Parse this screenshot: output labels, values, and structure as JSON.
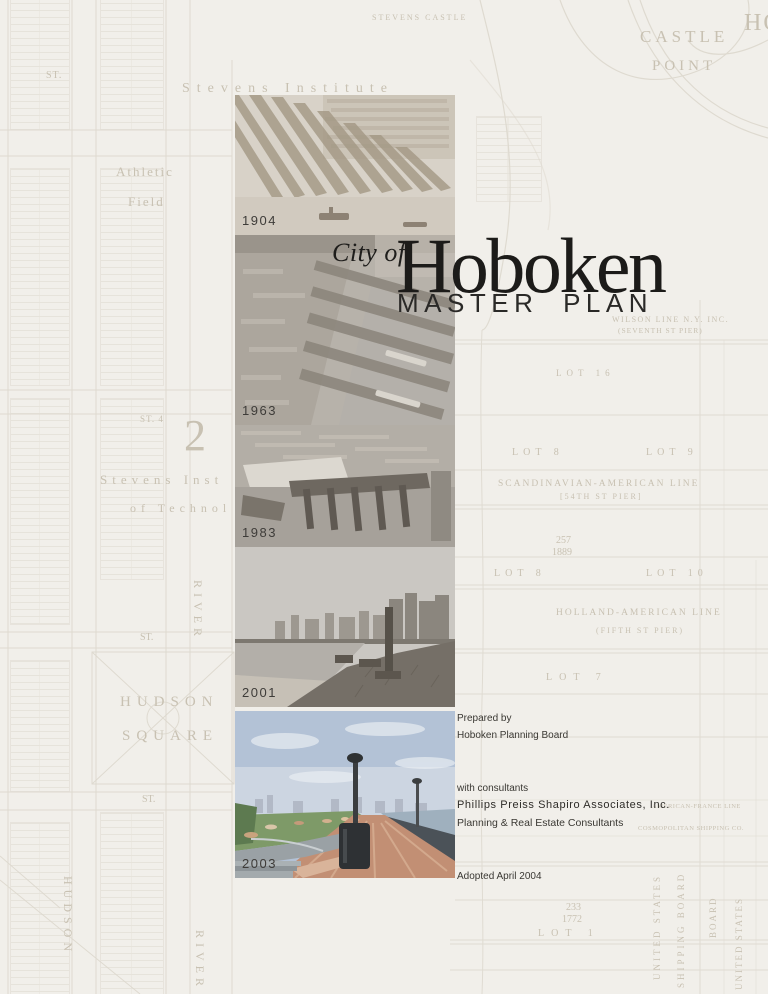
{
  "title": {
    "prefix": "City of",
    "name": "Hoboken",
    "subtitle": "MASTER PLAN"
  },
  "photos": [
    {
      "year": "1904",
      "description": "sepia aerial view of Hoboken piers"
    },
    {
      "year": "1963",
      "description": "aerial view of waterfront piers"
    },
    {
      "year": "1983",
      "description": "aerial view of pier complex and harbor"
    },
    {
      "year": "2001",
      "description": "black and white shoreline with skyline"
    },
    {
      "year": "2003",
      "description": "color photo of waterfront walkway and lawn"
    }
  ],
  "credits": {
    "prepared_label": "Prepared by",
    "prepared_by": "Hoboken Planning Board",
    "consultants_label": "with consultants",
    "consultant_name": "Phillips Preiss Shapiro Associates, Inc.",
    "consultant_role": "Planning & Real Estate Consultants",
    "adopted": "Adopted April 2004"
  },
  "map": {
    "labels": [
      "STEVENS CASTLE",
      "CASTLE",
      "POINT",
      "Stevens Institute",
      "Athletic",
      "Field",
      "ST.",
      "ST. 4",
      "2",
      "Stevens Inst",
      "of Technol",
      "HUDSON",
      "SQUARE",
      "ST.",
      "ST.",
      "HUDSON",
      "RIVER",
      "RIVER",
      "WILSON LINE N.Y. INC.",
      "(SEVENTH ST PIER)",
      "LOT 16",
      "LOT 8",
      "LOT 9",
      "SCANDINAVIAN-AMERICAN LINE",
      "[54TH ST PIER]",
      "257",
      "1889",
      "LOT 8",
      "LOT 10",
      "HOLLAND-AMERICAN LINE",
      "(FIFTH ST PIER)",
      "LOT 7",
      "AMERICAN-FRANCE LINE",
      "COSMOPOLITAN SHIPPING CO.",
      "233",
      "1772",
      "LOT 1",
      "UNITED STATES",
      "SHIPPING BOARD",
      "BOARD",
      "UNITED STATES",
      "HO"
    ]
  },
  "colors": {
    "page_background": "#f1efea",
    "map_line": "#ddd8ce",
    "map_text": "#c8c1b2",
    "title_text": "#1c1b19",
    "body_text": "#3a3833",
    "photo_sky_blue": "#b3c2d6",
    "photo_grass_green": "#7e9a68",
    "photo_boardwalk": "#c28f74"
  }
}
